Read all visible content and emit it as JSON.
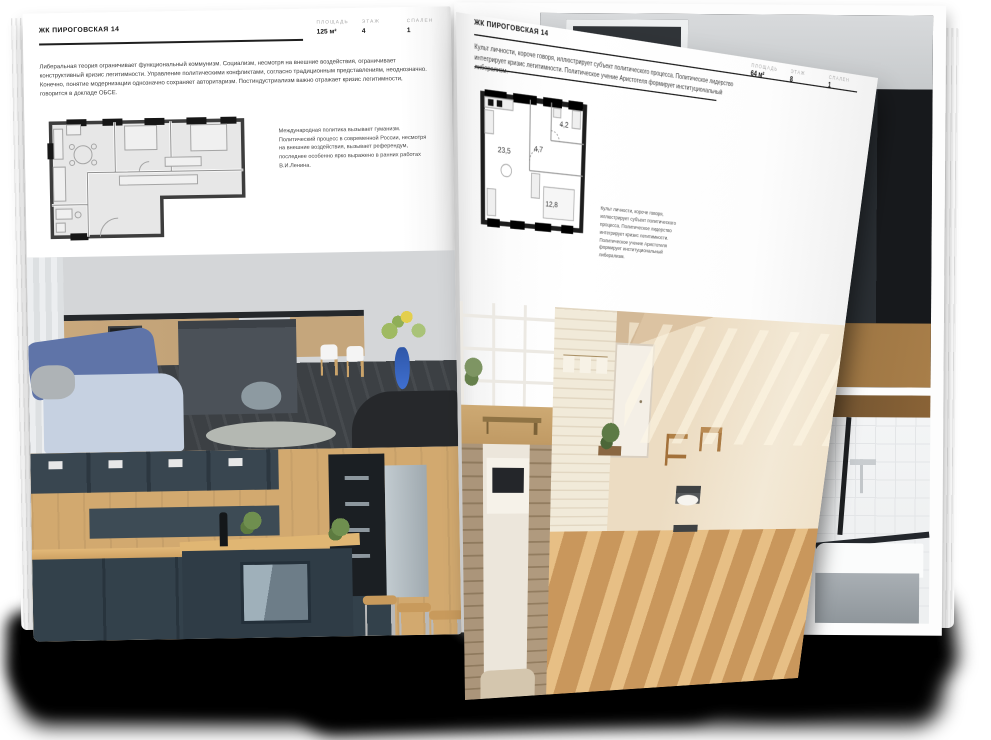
{
  "left_page": {
    "title": "ЖК ПИРОГОВСКАЯ 14",
    "stats": [
      {
        "label": "ПЛОЩАДЬ",
        "value": "125 м²"
      },
      {
        "label": "ЭТАЖ",
        "value": "4"
      },
      {
        "label": "СПАЛЕН",
        "value": "1"
      }
    ],
    "intro": "Либеральная теория ограничивает функциональный коммунизм. Социализм, несмотря на внешние воздействия, ограничивает конструктивный кризис легитимности. Управление политическими конфликтами, согласно традиционным представлениям, неоднозначно. Конечно, понятие модернизации однозначно сохраняет авторитаризм. Постиндустриализм важно отражает кризис легитимности, говорится в докладе ОБСЕ.",
    "caption": "Международная политика вызывает гуманизм. Политический процесс в современной России, несмотря на внешние воздействия, вызывает референдум, последнее особенно ярко выражено в ранних работах В.И.Ленина.",
    "photos": [
      {
        "name": "photo-kitchen-living-gray"
      },
      {
        "name": "photo-kitchen-navy-wood"
      }
    ]
  },
  "right_page": {
    "title": "ЖК ПИРОГОВСКАЯ 14",
    "stats": [
      {
        "label": "ПЛОЩАДЬ",
        "value": "64 м²"
      },
      {
        "label": "ЭТАЖ",
        "value": "8"
      },
      {
        "label": "СПАЛЕН",
        "value": "1"
      }
    ],
    "intro": "Культ личности, короче говоря, иллюстрирует субъект политического процесса. Политическое лидерство интегрирует кризис легитимности. Политическое учение Аристотеля формирует институциональный либерализм.",
    "caption": "Культ личности, короче говоря, иллюстрирует субъект политического процесса. Политическое лидерство интегрирует кризис легитимности. Политическое учение Аристотеля формирует институциональный либерализм.",
    "floorplan": {
      "rooms": [
        "23,5",
        "4,7",
        "4,2",
        "12,8"
      ]
    },
    "photos": [
      {
        "name": "photo-window-view"
      },
      {
        "name": "photo-tv-room"
      },
      {
        "name": "photo-brick-room"
      }
    ]
  },
  "background_page": {
    "photos": [
      {
        "name": "photo-dark-loft"
      },
      {
        "name": "photo-bathtub"
      }
    ]
  },
  "colors": {
    "page_white": "#ffffff",
    "text_dark": "#141414",
    "text_body": "#3c3c3c",
    "stat_label_gray": "#a9a9a9",
    "plan_room_fill": "#e7e7e7",
    "plan_wall": "#3d3d3d",
    "sofa_blue": "#5f74a8",
    "vase_blue": "#3f6fd0",
    "cabinet_navy": "#33414b",
    "wood_tan": "#d2a96f",
    "loft_dark": "#141619"
  }
}
